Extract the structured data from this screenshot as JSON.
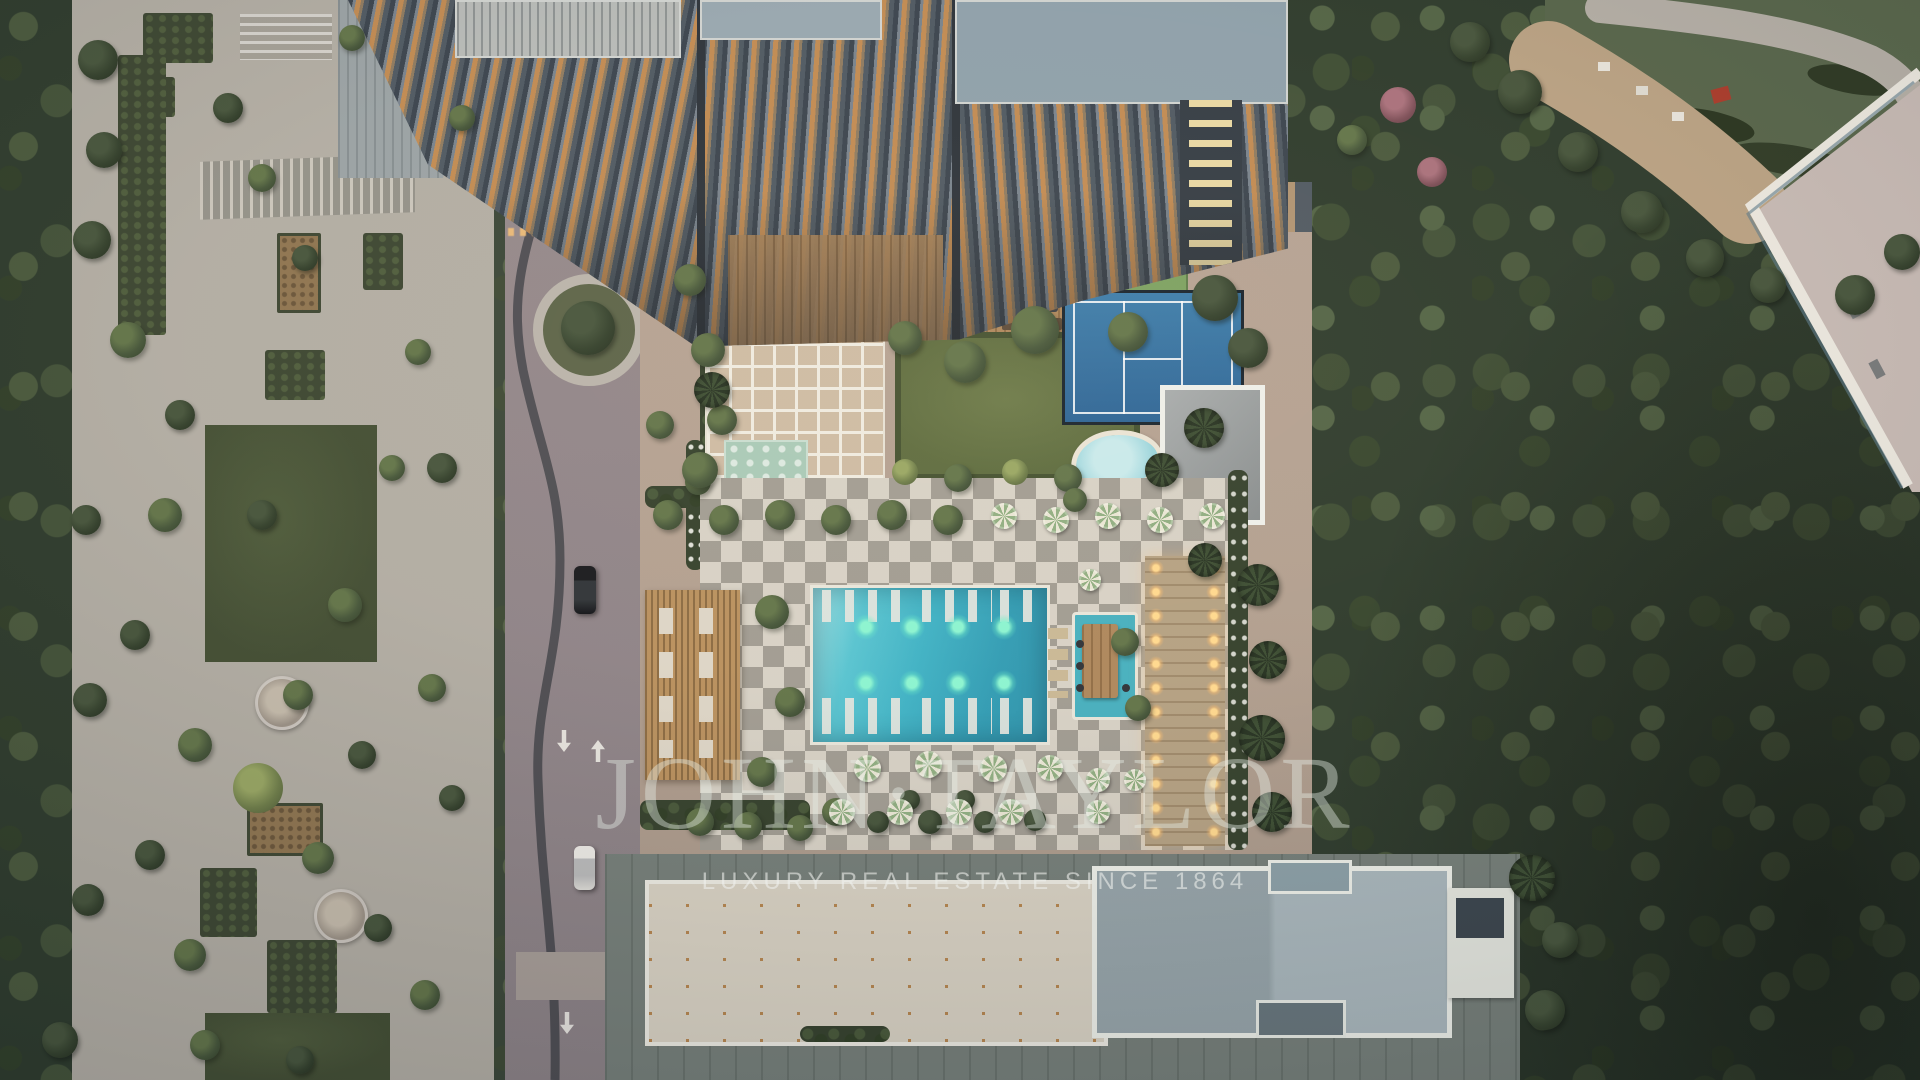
{
  "watermark": {
    "brand_wordmark": "JOHN·TAYLOR",
    "tagline": "LUXURY REAL ESTATE SINCE 1864"
  },
  "scene_elements": [
    "residential-tower",
    "balcony-terraces",
    "porte-cochere",
    "swimming-pool",
    "pool-lights",
    "sun-loungers",
    "pool-bar",
    "kids-splash-pool",
    "padel-court",
    "putting-green",
    "lawn",
    "pavilion-grid-roof",
    "wooden-pergola",
    "outdoor-dining-terrace",
    "white-canopies",
    "checkerboard-pool-deck",
    "pool-umbrellas",
    "lit-colonnade-walkway",
    "community-garden",
    "park-pathways",
    "garden-beds",
    "seating-pods",
    "driveway",
    "black-car",
    "white-car",
    "road-arrow-markings",
    "tree-planter",
    "forest",
    "rooftop-skylight-tiles",
    "slate-flat-roof",
    "neighboring-building",
    "perimeter-wall",
    "construction-area"
  ],
  "palette": {
    "pool_water": "#3aa8bd",
    "pool_light_glow": "#8af5d2",
    "splash_pool": "#a5dbe4",
    "padel_court": "#2e6da1",
    "checker_light": "#d7d2c7",
    "checker_dark": "#a09c93",
    "deck_wood": "#ad875c",
    "balcony_light": "#c08a52",
    "lawn_green": "#5c6b3e",
    "forest_green": "#2c3a2c",
    "park_paving": "#b1ada4",
    "plaza_road": "#8f8489",
    "roof_slate": "#a2b2b8",
    "roof_tile_gap": "#b5854f",
    "watermark_text": "#e9ede7"
  }
}
